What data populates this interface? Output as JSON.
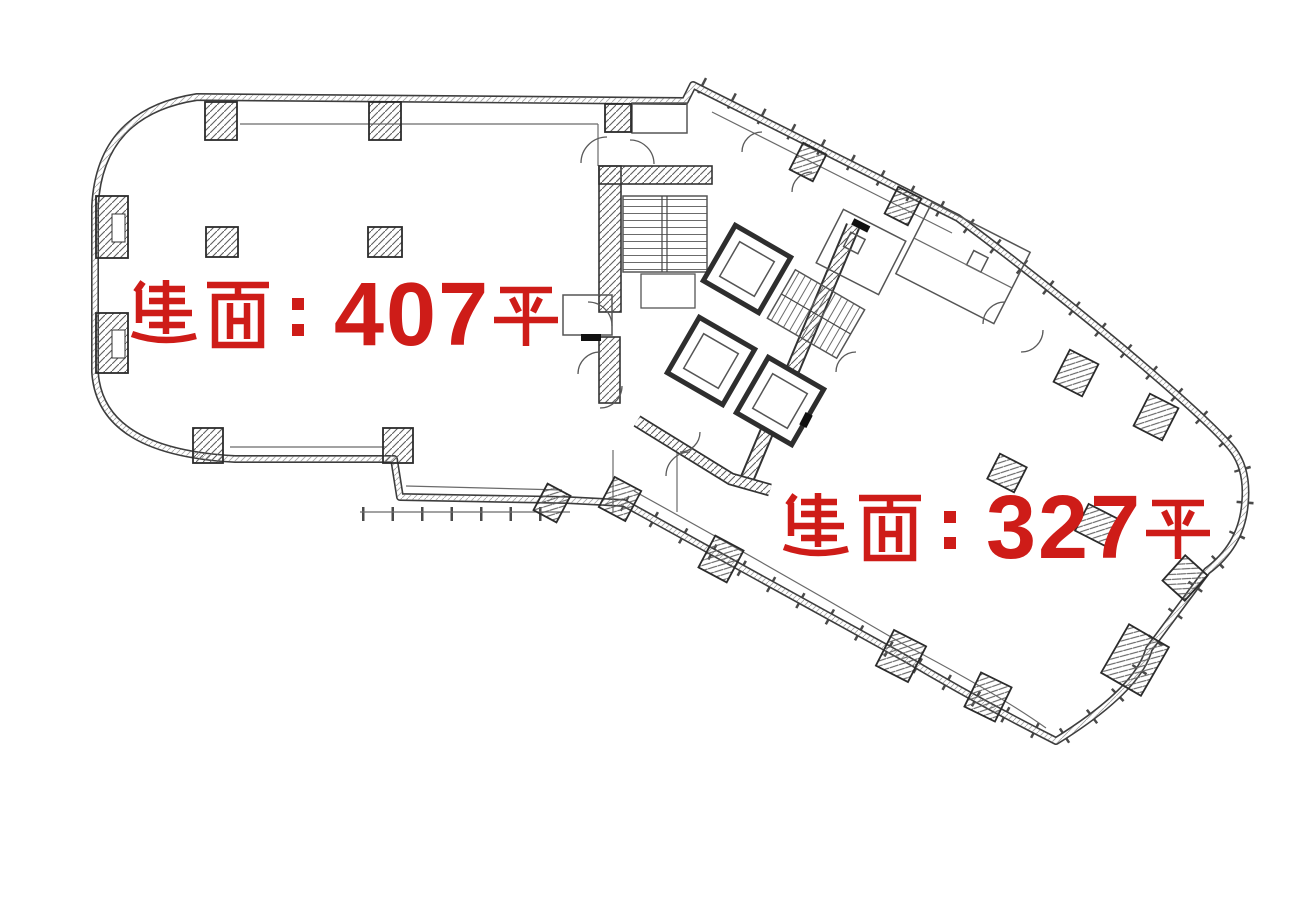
{
  "page": {
    "background_color": "#ffffff",
    "drawing_line_color": "#3d3d3d",
    "label_color": "#ce1c18"
  },
  "floorplan": {
    "type": "architectural-floor-plan",
    "description": "Two-wing tower floor plate with central elevator/stair core, perimeter columns and curtain-wall tick marks",
    "units": [
      {
        "name": "left-unit",
        "area_label": "建面：407平",
        "area_sqm": 407
      },
      {
        "name": "right-unit",
        "area_label": "建面：327平",
        "area_sqm": 327
      }
    ]
  },
  "labels": {
    "left": {
      "text": "建面：407平",
      "prefix": "建面：",
      "number": "407",
      "suffix": "平",
      "color": "#ce1c18"
    },
    "right": {
      "text": "建面：327平",
      "prefix": "建面：",
      "number": "327",
      "suffix": "平",
      "color": "#ce1c18"
    }
  }
}
